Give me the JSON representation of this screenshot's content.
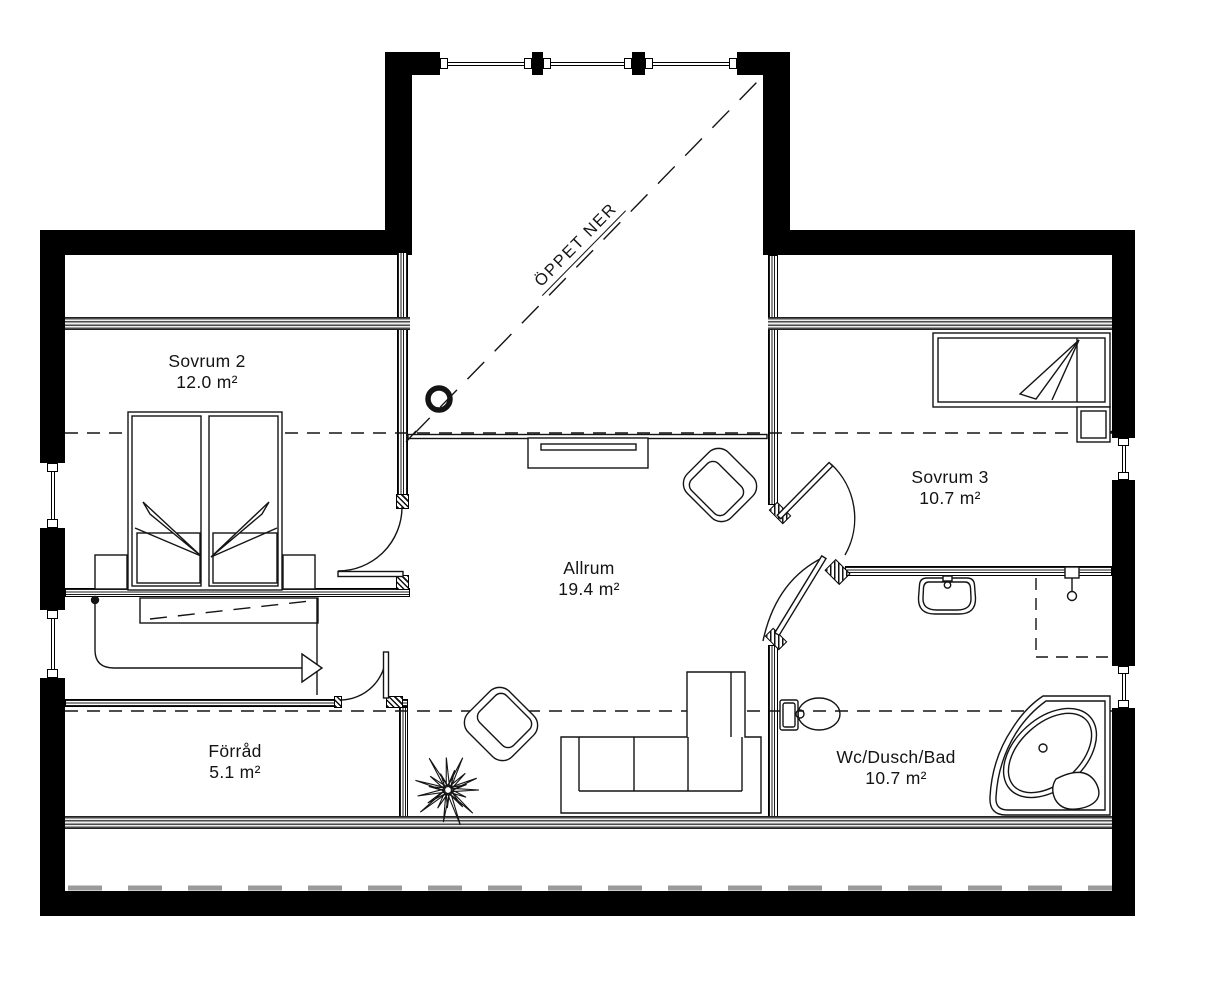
{
  "floorplan": {
    "annotations": {
      "open_below": "ÖPPET NER"
    },
    "rooms": [
      {
        "id": "sovrum-2",
        "name": "Sovrum 2",
        "area": "12.0 m²"
      },
      {
        "id": "sovrum-3",
        "name": "Sovrum 3",
        "area": "10.7 m²"
      },
      {
        "id": "allrum",
        "name": "Allrum",
        "area": "19.4 m²"
      },
      {
        "id": "forrad",
        "name": "Förråd",
        "area": "5.1 m²"
      },
      {
        "id": "wc-dusch-bad",
        "name": "Wc/Dusch/Bad",
        "area": "10.7 m²"
      }
    ],
    "colors": {
      "wall": "#000000",
      "line": "#141414",
      "eaves_dash": "#9a9a9a",
      "background": "#ffffff"
    }
  }
}
